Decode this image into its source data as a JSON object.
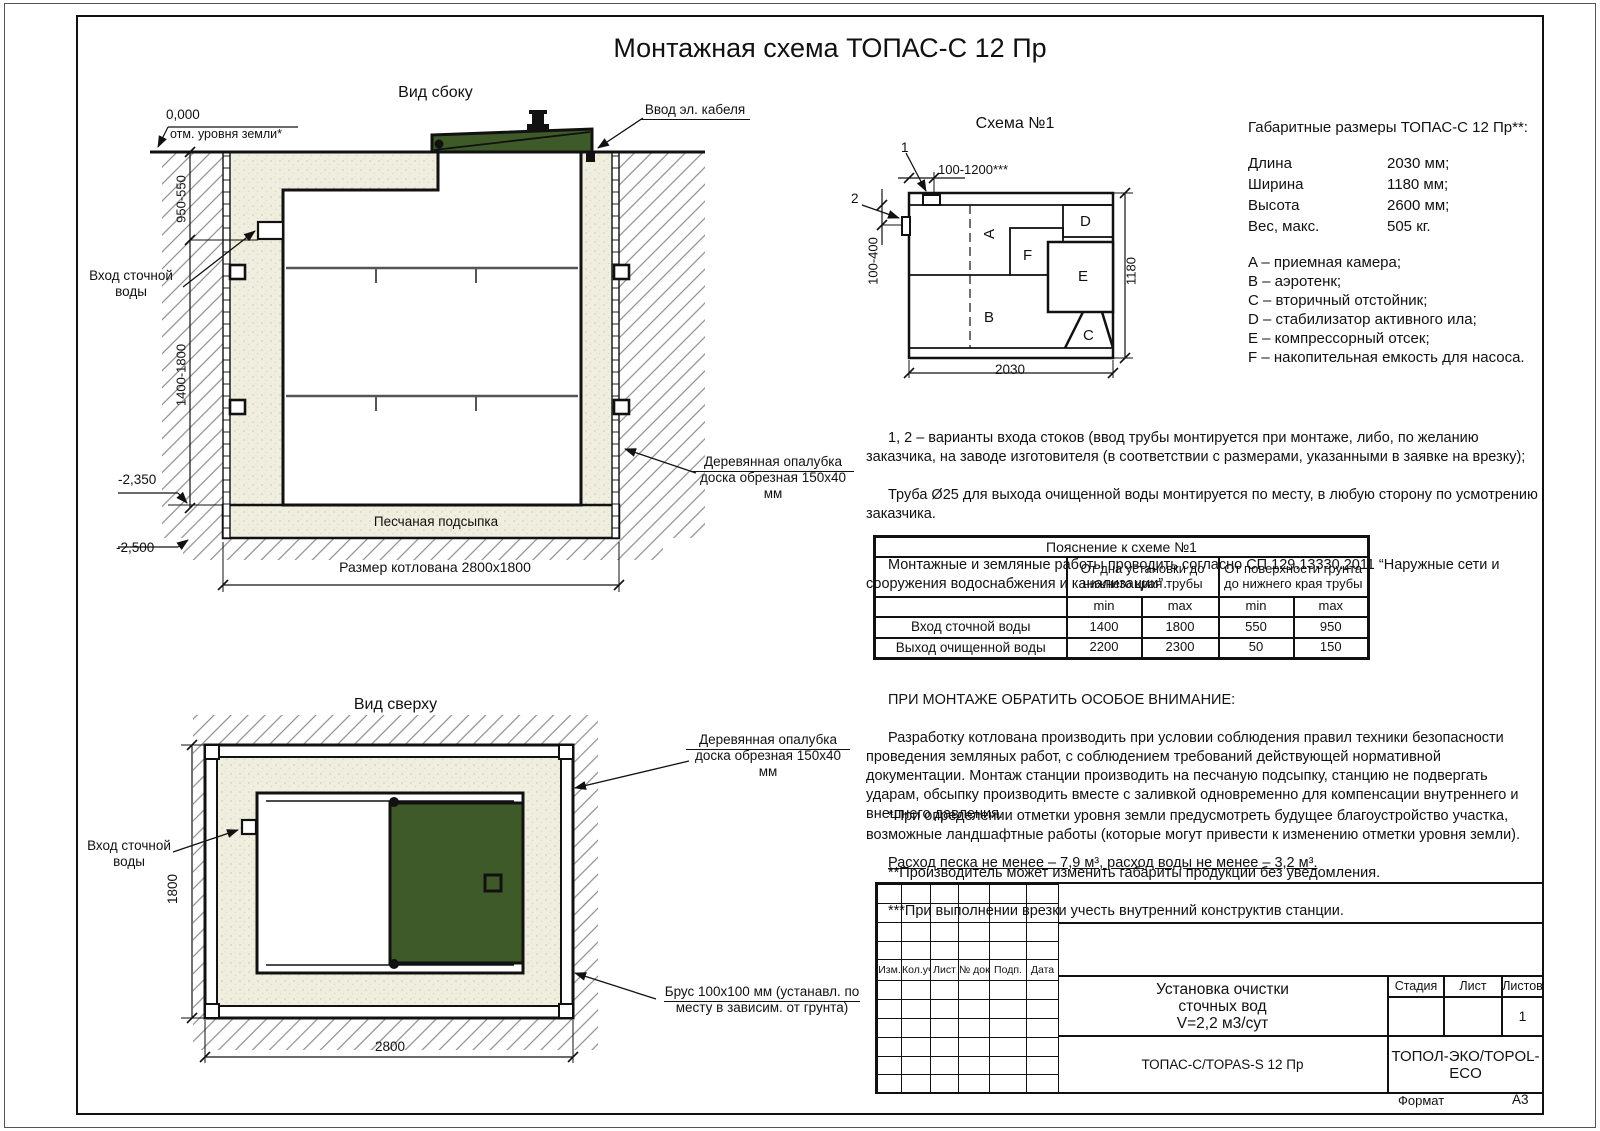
{
  "title": "Монтажная схема ТОПАС-С 12 Пр",
  "side_view": {
    "label": "Вид сбоку",
    "zero_mark": "0,000",
    "zero_caption": "отм. уровня земли*",
    "dim_upper": "950-550",
    "dim_lower": "1400-1800",
    "mark_bottom1": "-2,350",
    "mark_bottom2": "-2,500",
    "inlet_label": "Вход сточной\nводы",
    "cable_label": "Ввод эл. кабеля",
    "formwork_label": "Деревянная опалубка\nдоска обрезная 150х40 мм",
    "sand_label": "Песчаная подсыпка",
    "pit_dim": "Размер котлована 2800х1800"
  },
  "top_view": {
    "label": "Вид сверху",
    "inlet_label": "Вход сточной\nводы",
    "formwork_label": "Деревянная опалубка\nдоска обрезная 150х40 мм",
    "beam_label": "Брус 100х100 мм (устанавл. по\nместу в зависим. от грунта)",
    "dim_width": "2800",
    "dim_height": "1800"
  },
  "schema": {
    "title": "Схема №1",
    "marker1": "1",
    "marker2": "2",
    "dim_top": "100-1200***",
    "dim_left": "100-400",
    "dim_right": "1180",
    "dim_bottom": "2030",
    "A": "A",
    "B": "B",
    "C": "C",
    "D": "D",
    "E": "E",
    "F": "F"
  },
  "specs": {
    "title": "Габаритные размеры ТОПАС-С 12 Пр**:",
    "rows": [
      {
        "k": "Длина",
        "v": "2030 мм;"
      },
      {
        "k": "Ширина",
        "v": "1180 мм;"
      },
      {
        "k": "Высота",
        "v": "2600 мм;"
      },
      {
        "k": "Вес, макс.",
        "v": "505 кг."
      }
    ],
    "legend": [
      "A – приемная камера;",
      "B – аэротенк;",
      "C – вторичный отстойник;",
      "D – стабилизатор активного ила;",
      "E – компрессорный отсек;",
      "F – накопительная емкость для насоса."
    ]
  },
  "notes": {
    "p1": "1, 2 – варианты входа  стоков (ввод трубы монтируется при монтаже, либо, по желанию заказчика, на заводе изготовителя (в соответствии с размерами, указанными в заявке на врезку);",
    "p2": "Труба Ø25 для выхода очищенной воды монтируется по месту, в любую сторону по усмотрению заказчика.",
    "p3": "Монтажные и земляные работы проводить согласно СП 129.13330.2011 “Наружные сети и сооружения водоснабжения и канализации”."
  },
  "table": {
    "title": "Пояснение к схеме №1",
    "group1": "От дна установки до\nнижнего края трубы",
    "group2": "От поверхности грунта\nдо нижнего края трубы",
    "min1": "min",
    "max1": "max",
    "min2": "min",
    "max2": "max",
    "rows": [
      {
        "label": "Вход сточной воды",
        "c1": "1400",
        "c2": "1800",
        "c3": "550",
        "c4": "950"
      },
      {
        "label": "Выход очищенной воды",
        "c1": "2200",
        "c2": "2300",
        "c3": "50",
        "c4": "150"
      }
    ]
  },
  "attention": {
    "heading": "ПРИ МОНТАЖЕ ОБРАТИТЬ ОСОБОЕ ВНИМАНИЕ:",
    "body": "Разработку котлована производить при условии соблюдения правил техники безопасности проведения земляных работ, с соблюдением требований действующей нормативной документации. Монтаж станции производить на песчаную подсыпку, станцию не подвергать ударам, обсыпку производить вместе с заливкой одновременно для компенсации внутреннего и внешнего давления.",
    "star1": "*При определении отметки уровня земли предусмотреть будущее благоустройство участка, возможные ландшафтные работы (которые могут привести к изменению отметки уровня земли).",
    "star2": "**Производитель может изменить габариты продукции без уведомления.",
    "star3": "***При выполнении врезки учесть внутренний конструктив станции.",
    "sand_note": "Расход песка не менее – 7,9 м³, расход воды не менее – 3,2 м³."
  },
  "stamp": {
    "rev_cols": [
      "Изм.",
      "Кол.уч.",
      "Лист",
      "№ док.",
      "Подп.",
      "Дата"
    ],
    "doc_title": "Установка очистки\nсточных вод\nV=2,2 м3/сут",
    "stage_label": "Стадия",
    "sheet_label": "Лист",
    "sheets_label": "Листов",
    "sheets_value": "1",
    "model": "ТОПАС-С/TOPAS-S 12 Пр",
    "company": "ТОПОЛ-ЭКО/TOPOL-ECO",
    "format_label": "Формат",
    "format_value": "А3"
  },
  "colors": {
    "lid_green": "#3d5a28",
    "sand": "#f0eede",
    "line": "#111111"
  }
}
